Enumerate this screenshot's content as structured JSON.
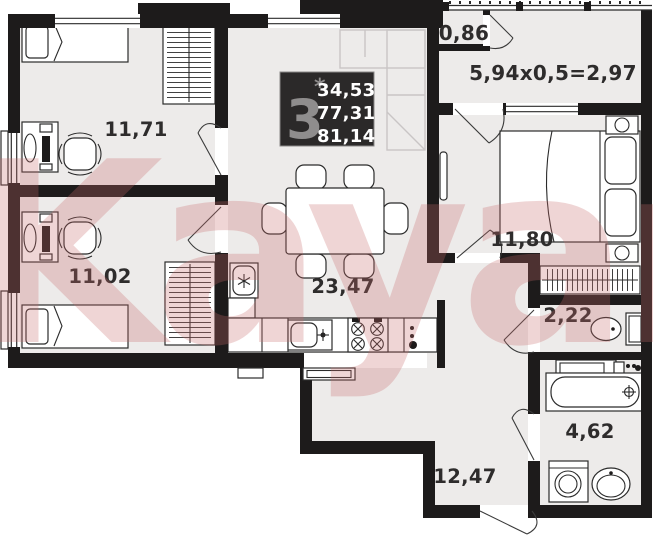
{
  "floorplan": {
    "watermark": "Kayan",
    "info_badge": {
      "room_count": "3",
      "star": "*",
      "area_living": "34,53",
      "area_apartment": "77,31",
      "area_total": "81,14"
    },
    "labels": {
      "bedroom_top_left": "11,71",
      "bedroom_bottom_left": "11,02",
      "kitchen_living": "23,47",
      "bedroom_right": "11,80",
      "toilet": "2,22",
      "bathroom": "4,62",
      "hallway": "12,47",
      "balcony_closet": "0,86",
      "balcony_formula": "5,94x0,5=2,97"
    },
    "colors": {
      "wall": "#1d1b1b",
      "floor": "#edebea",
      "badge_bg": "#2b2929",
      "badge_number": "#8f8d8d",
      "badge_text": "#ffffff",
      "watermark": "#c96a6a",
      "label_text": "#2e2c2c"
    }
  }
}
